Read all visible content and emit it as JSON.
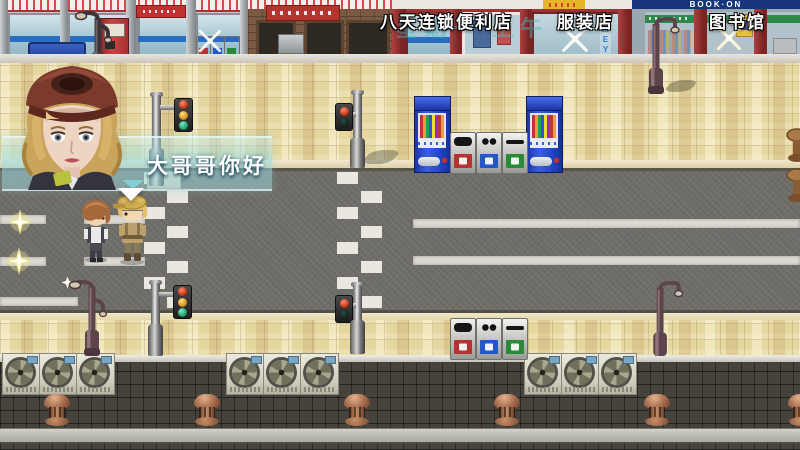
{
  "hud": {
    "location_labels": [
      {
        "id": "convenience-store",
        "text": "八天连锁便利店"
      },
      {
        "id": "clothing-store",
        "text": "服装店"
      },
      {
        "id": "library",
        "text": "图书馆"
      }
    ],
    "time_watermark": "星期一 上午"
  },
  "dialogue": {
    "text": "大哥哥你好",
    "portrait": "blonde-girl-red-cap",
    "continue_indicator": "down-arrow"
  },
  "storefront_texts": {
    "book_sign": "BOOK·ON",
    "window_vertical": "OMEYA"
  },
  "palette": {
    "dialog_teal": "#9fdce4",
    "sidewalk_tan": "#e6d7a0",
    "road_gray": "#6f6d68",
    "vending_blue": "#2347c8",
    "roof_dark": "#46423c",
    "sign_text": "#ffffff",
    "watermark_teal": "#3ec0cc"
  }
}
